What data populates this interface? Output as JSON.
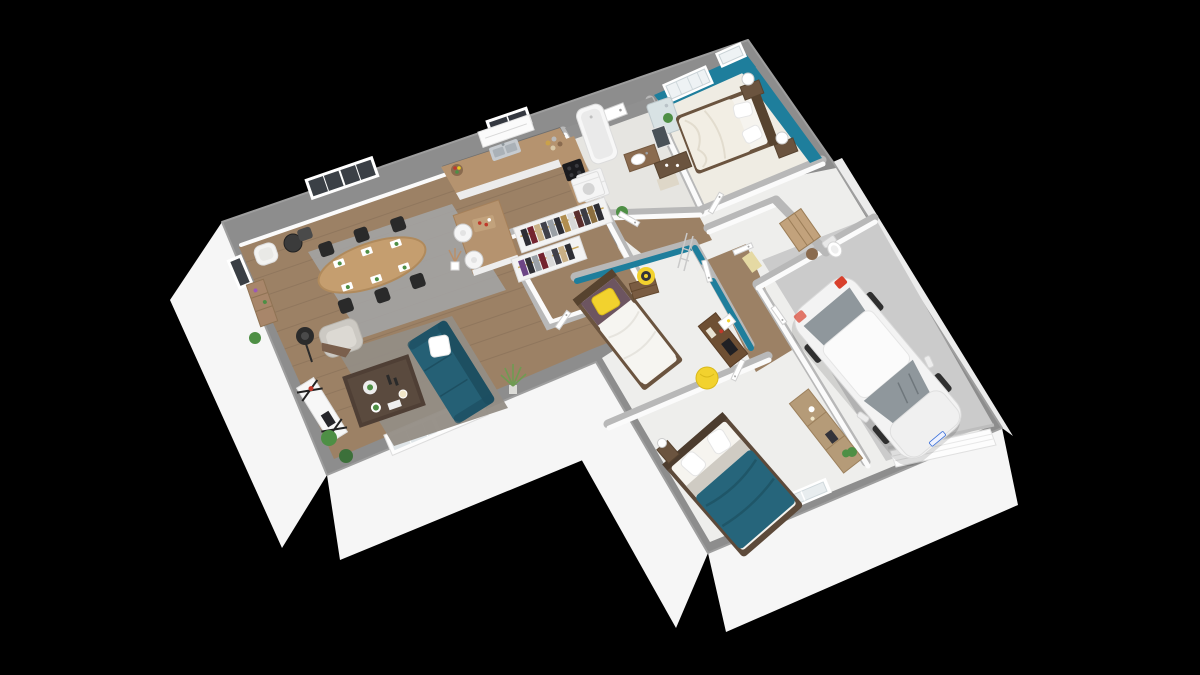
{
  "colors": {
    "bg": "#000000",
    "wallTop": "#8d8d8d",
    "wallCap": "#b8b8b8",
    "innerWall": "#fbfbfb",
    "outerFace": "#f6f6f6",
    "outerFaceShade": "#e7e7e7",
    "teal": "#1e7e9c",
    "woodFloor": "#9c8165",
    "kitchenWood": "#b5936f",
    "whiteFloor": "#eeeeec",
    "cream": "#efece3",
    "tileFloor": "#e6e5e1",
    "tileWall": "#909090",
    "backsplash": "#6f6f6f",
    "garageFloor": "#cbcbcb",
    "rug": "#a3a3a3",
    "rugWarm": "#948d85",
    "sofa": "#256075",
    "sofaDark": "#1d4f61",
    "duvetTeal": "#26657b",
    "bedFrame": "#6b543f",
    "mattress": "#f6f4ef",
    "pillow": "#ffffff",
    "blanketGray": "#cfcbc3",
    "yellow": "#f2d22e",
    "maroon": "#6d5560",
    "deskWood": "#6e4f33",
    "woodMid": "#a8866a",
    "woodLight": "#c2a27c",
    "black": "#2a2a2a",
    "white": "#ffffff",
    "steel": "#c6cbd0",
    "carBody": "#f3f3f3",
    "glass": "#8f979c",
    "glassLight": "#dfe5e8",
    "red": "#c0392b",
    "green": "#4e8f45",
    "greenDark": "#3c703a"
  },
  "scene": {
    "type": "isometric-3d-floorplan-render",
    "background": "#000000",
    "house_shape": "L-shaped single storey with attached garage",
    "accent_wall_color": "#1e7e9c",
    "rooms": [
      {
        "name": "living-dining-room",
        "floor": "wood",
        "items": [
          "teal-sofa",
          "white-cushion",
          "gray-armchair",
          "brown-throw",
          "dark-coffee-table",
          "flower-vase",
          "tv-sideboard",
          "floor-lamp",
          "gray-rugs",
          "oval-dining-table",
          "six-black-chairs",
          "place-settings",
          "reading-chair",
          "round-side-table",
          "ladder-shelf",
          "potted-plants",
          "sliding-glass-door",
          "double-french-window",
          "side-window"
        ]
      },
      {
        "name": "kitchen",
        "floor": "wood",
        "items": [
          "l-shaped-counter",
          "stainless-sink",
          "cooktop",
          "fridge",
          "range-hood",
          "backsplash",
          "window",
          "fruit-bowl",
          "jars",
          "island",
          "two-bar-stools",
          "serving-board"
        ]
      },
      {
        "name": "walk-in-closet",
        "floor": "wood",
        "items": [
          "two-clothes-racks",
          "hanging-clothes",
          "plant"
        ]
      },
      {
        "name": "bathroom",
        "floor": "tile",
        "items": [
          "bathtub",
          "shower",
          "vanity-sink",
          "mirror",
          "washing-machine",
          "bath-mat"
        ]
      },
      {
        "name": "master-bedroom",
        "walls": "teal",
        "floor": "cream-carpet",
        "items": [
          "double-bed",
          "white-bedding",
          "two-nightstands",
          "two-ball-lamps",
          "low-dresser",
          "shuttered-windows"
        ]
      },
      {
        "name": "bedroom-2",
        "walls": "teal-accent",
        "floor": "white",
        "items": [
          "single-bed",
          "yellow-pillow",
          "maroon-headrest",
          "nightstand",
          "round-yellow-wall-art",
          "decor-ladder",
          "desk",
          "laptop",
          "yellow-beanbag",
          "poster"
        ]
      },
      {
        "name": "bedroom-3",
        "floor": "white",
        "items": [
          "double-bed",
          "teal-duvet",
          "white-pillows",
          "nightstand",
          "ball-lamp",
          "window"
        ]
      },
      {
        "name": "wc-laundry",
        "items": [
          "toilet",
          "slatted-shelving-unit",
          "basket",
          "door-mat"
        ]
      },
      {
        "name": "hallway",
        "floor": "wood",
        "items": [
          "white-doors"
        ]
      },
      {
        "name": "garage",
        "floor": "concrete",
        "items": [
          "white-car",
          "red-taillight",
          "wood-sideboard",
          "plant",
          "garage-door"
        ]
      }
    ]
  }
}
